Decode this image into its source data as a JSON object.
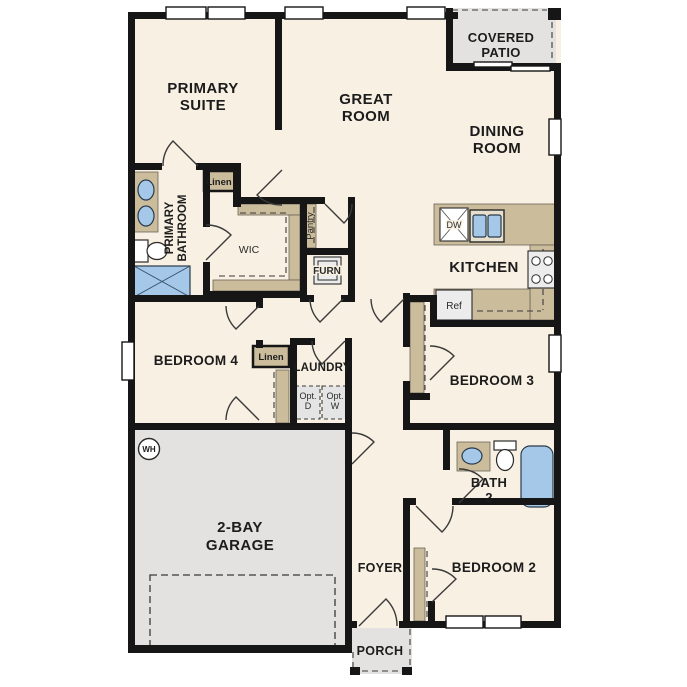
{
  "rooms": {
    "primary_suite": {
      "line1": "PRIMARY",
      "line2": "SUITE"
    },
    "great_room": {
      "line1": "GREAT",
      "line2": "ROOM"
    },
    "covered_patio": {
      "line1": "COVERED",
      "line2": "PATIO"
    },
    "dining_room": {
      "line1": "DINING",
      "line2": "ROOM"
    },
    "kitchen": {
      "label": "KITCHEN"
    },
    "primary_bathroom": {
      "line1": "PRIMARY",
      "line2": "BATHROOM"
    },
    "wic": {
      "label": "WIC"
    },
    "pantry": {
      "label": "Pantry"
    },
    "furnace": {
      "label": "FURN"
    },
    "linen_hall": {
      "label": "Linen"
    },
    "linen_bedroom4": {
      "label": "Linen"
    },
    "bedroom4": {
      "label": "BEDROOM 4"
    },
    "laundry": {
      "label": "LAUNDRY"
    },
    "opt_dryer": {
      "line1": "Opt.",
      "line2": "D"
    },
    "opt_washer": {
      "line1": "Opt.",
      "line2": "W"
    },
    "bedroom3": {
      "label": "BEDROOM 3"
    },
    "bath2": {
      "line1": "BATH",
      "line2": "2"
    },
    "bedroom2": {
      "label": "BEDROOM 2"
    },
    "garage": {
      "line1": "2-BAY",
      "line2": "GARAGE"
    },
    "foyer": {
      "label": "FOYER"
    },
    "porch": {
      "label": "PORCH"
    }
  },
  "fixtures": {
    "dishwasher": "DW",
    "refrigerator": "Ref",
    "water_heater": "WH"
  },
  "colors": {
    "floor": "#f8f0e2",
    "hardscape": "#e3e2e0",
    "wall": "#161616",
    "cabinetry": "#cbbc9c",
    "plumbing_blue": "#a6c8e8",
    "appliance": "#ececec",
    "text": "#1c1c1c"
  }
}
